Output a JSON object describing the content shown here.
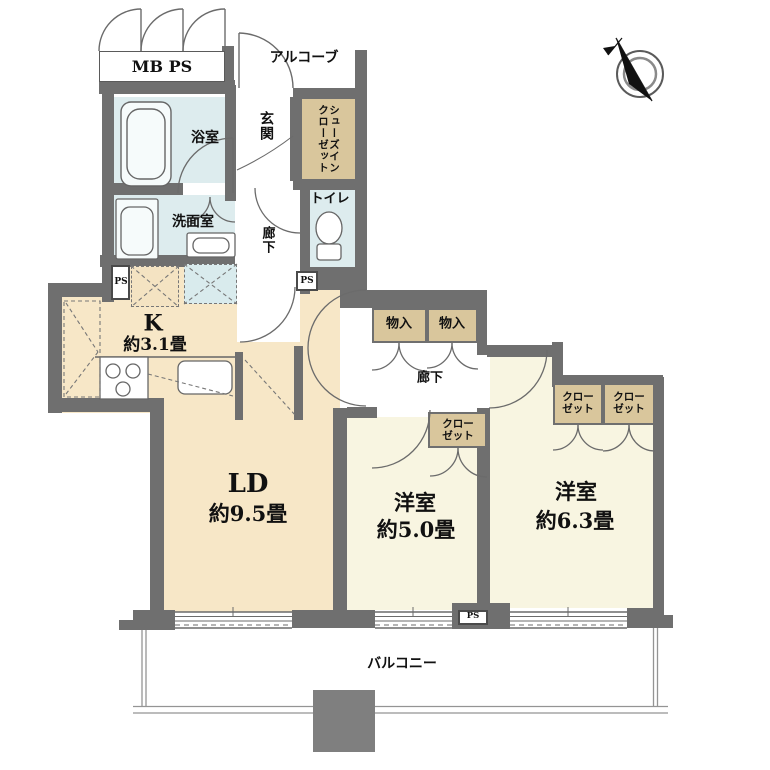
{
  "meta": {
    "type": "apartment-floor-plan"
  },
  "colors": {
    "wall": "#6f6f6f",
    "water_rooms": "#ddecee",
    "ldk_floor": "#f7e7c7",
    "bedroom_floor": "#f8f5e1",
    "closet_fill": "#d9c69c",
    "text": "#111111",
    "balcony_line": "#949494",
    "pillar": "#7f7f7f"
  },
  "labels": {
    "mb_ps": "MB PS",
    "alcove": "アルコーブ",
    "entrance": "玄関",
    "shoe_closet_line1": "シューズイン",
    "shoe_closet_line2": "クローゼット",
    "bathroom": "浴室",
    "washroom": "洗面室",
    "toilet": "トイレ",
    "hallway": "廊下",
    "ps": "PS",
    "storage": "物入",
    "closet_line1": "クロー",
    "closet_line2": "ゼット",
    "balcony": "バルコニー"
  },
  "rooms": {
    "kitchen": {
      "name": "K",
      "size": "約3.1畳"
    },
    "living_dining": {
      "name": "LD",
      "size": "約9.5畳"
    },
    "bedroom_1": {
      "name": "洋室",
      "size": "約5.0畳"
    },
    "bedroom_2": {
      "name": "洋室",
      "size": "約6.3畳"
    }
  }
}
